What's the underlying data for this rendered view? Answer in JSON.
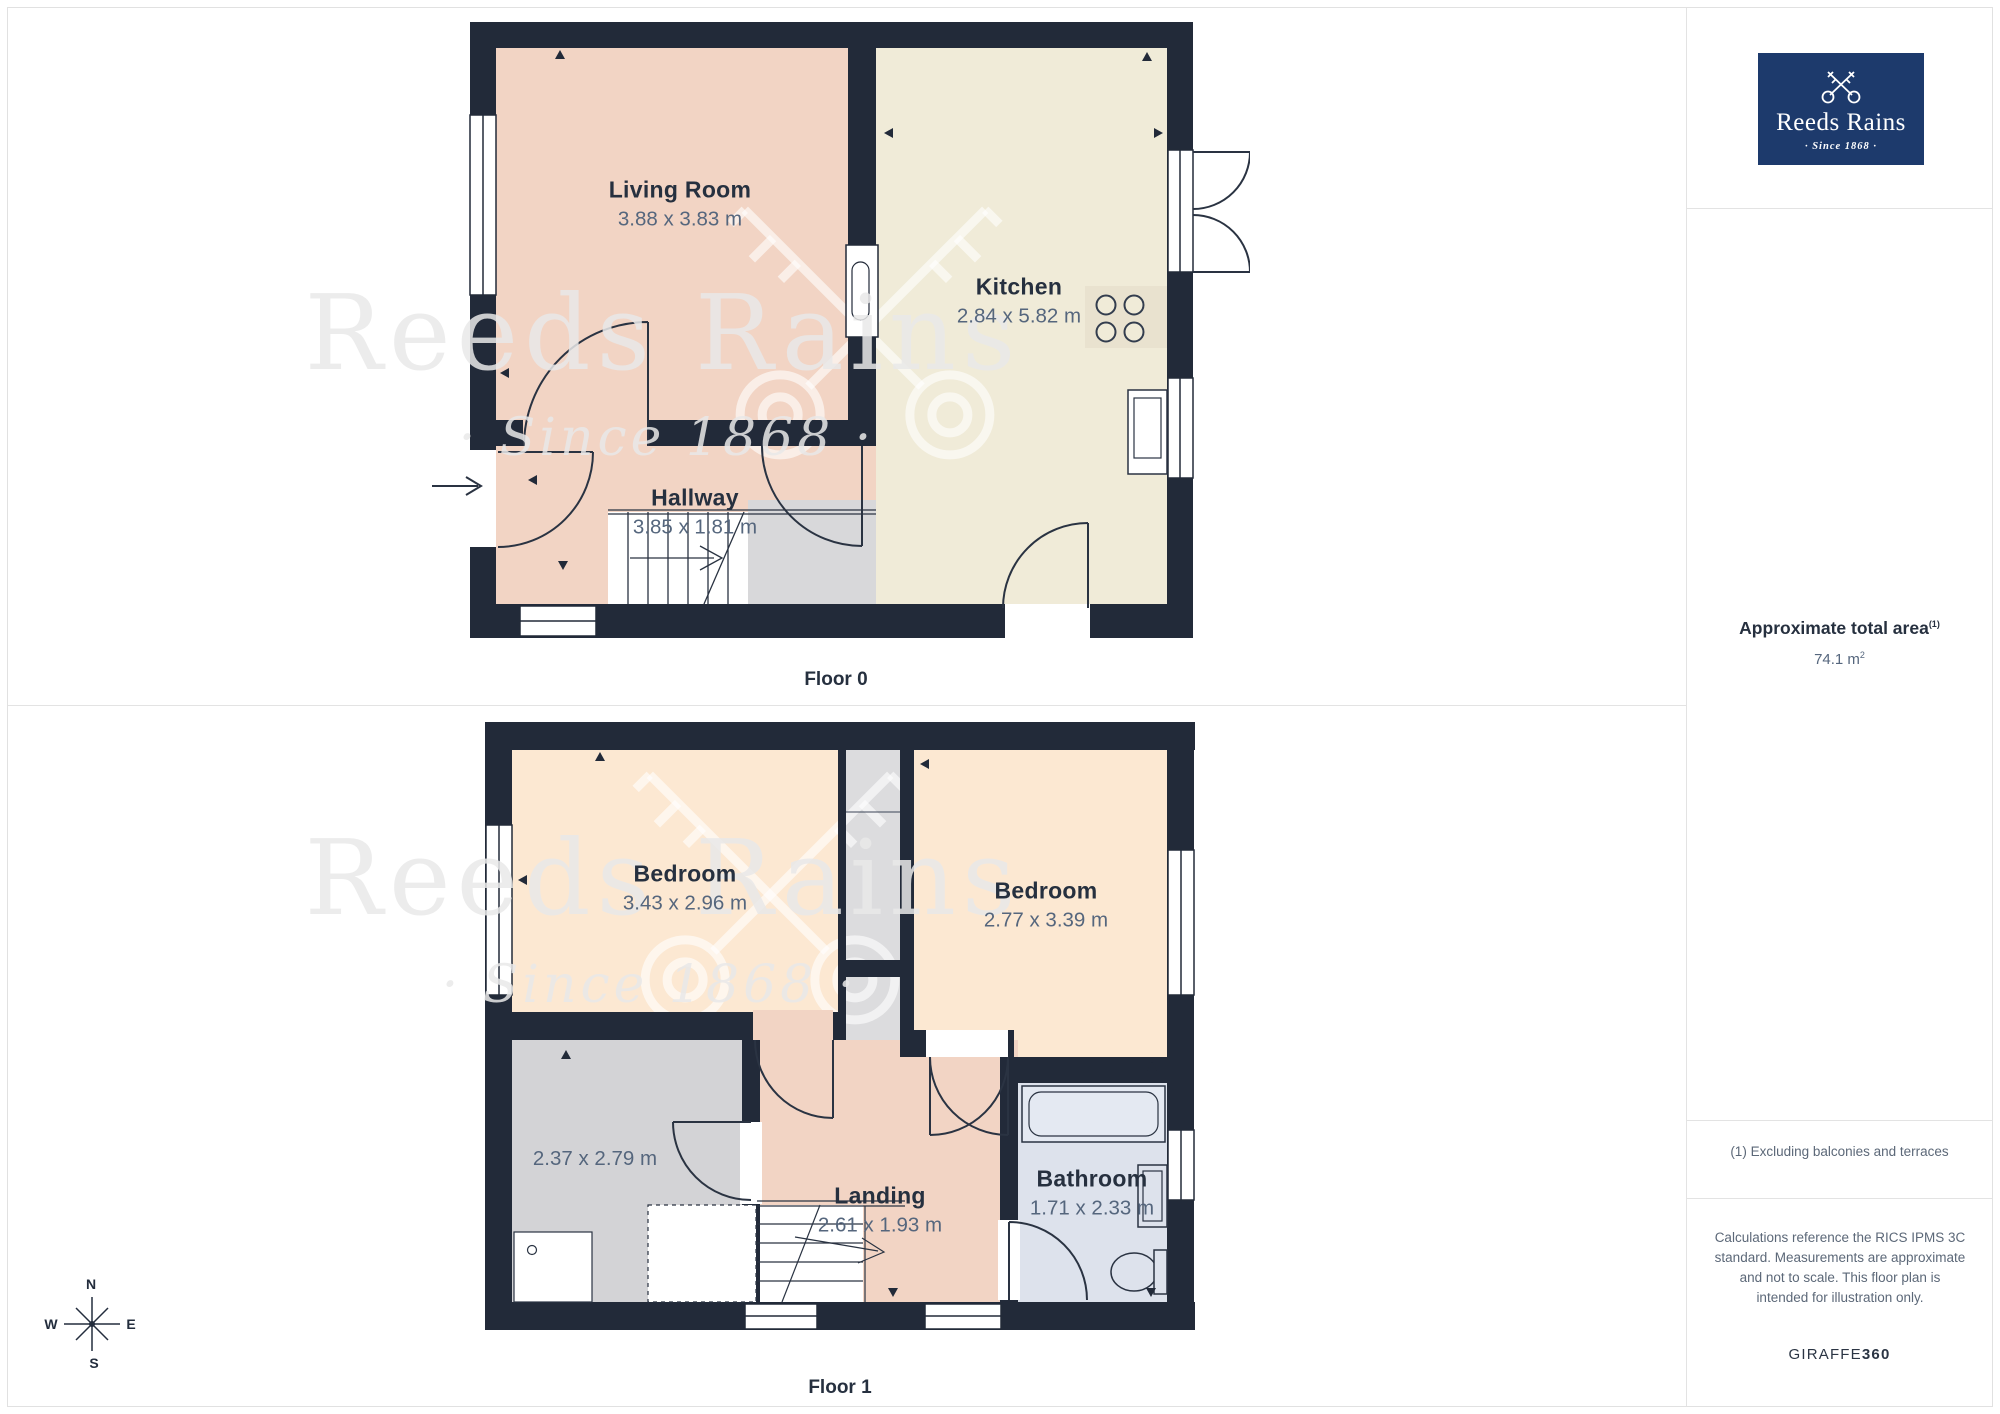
{
  "sidebar": {
    "logo": {
      "title": "Reeds Rains",
      "tagline": "· Since 1868 ·",
      "bg_color": "#1d3a6c"
    },
    "area": {
      "label": "Approximate total area",
      "label_sup": "(1)",
      "value": "74.1 m",
      "value_sup": "2"
    },
    "footnote": "(1) Excluding balconies and terraces",
    "disclaimer": "Calculations reference the RICS IPMS 3C standard. Measurements are approximate and not to scale. This floor plan is intended for illustration only.",
    "credit": {
      "normal": "GIRAFFE",
      "bold": "360"
    }
  },
  "floors": [
    {
      "label": "Floor 0",
      "rooms": [
        {
          "name": "Living Room",
          "dims": "3.88 x 3.83 m"
        },
        {
          "name": "Kitchen",
          "dims": "2.84 x 5.82 m"
        },
        {
          "name": "Hallway",
          "dims": "3.85 x 1.81 m"
        }
      ]
    },
    {
      "label": "Floor 1",
      "rooms": [
        {
          "name": "Bedroom",
          "dims": "3.43 x 2.96 m"
        },
        {
          "name": "Bedroom",
          "dims": "2.77 x 3.39 m"
        },
        {
          "name": "",
          "dims": "2.37 x 2.79 m"
        },
        {
          "name": "Landing",
          "dims": "2.61 x 1.93 m"
        },
        {
          "name": "Bathroom",
          "dims": "1.71 x 2.33 m"
        }
      ]
    }
  ],
  "watermark": {
    "text": "Reeds Rains",
    "tagline": "· Since 1868 ·"
  },
  "compass": {
    "n": "N",
    "e": "E",
    "s": "S",
    "w": "W"
  },
  "colors": {
    "wall": "#222a39",
    "living": "#f2d4c4",
    "kitchen": "#f0ebd8",
    "bedroom": "#fce8d2",
    "bathroom": "#dde2ec",
    "gray_room": "#d3d3d6",
    "logo_blue": "#1d3a6c"
  }
}
